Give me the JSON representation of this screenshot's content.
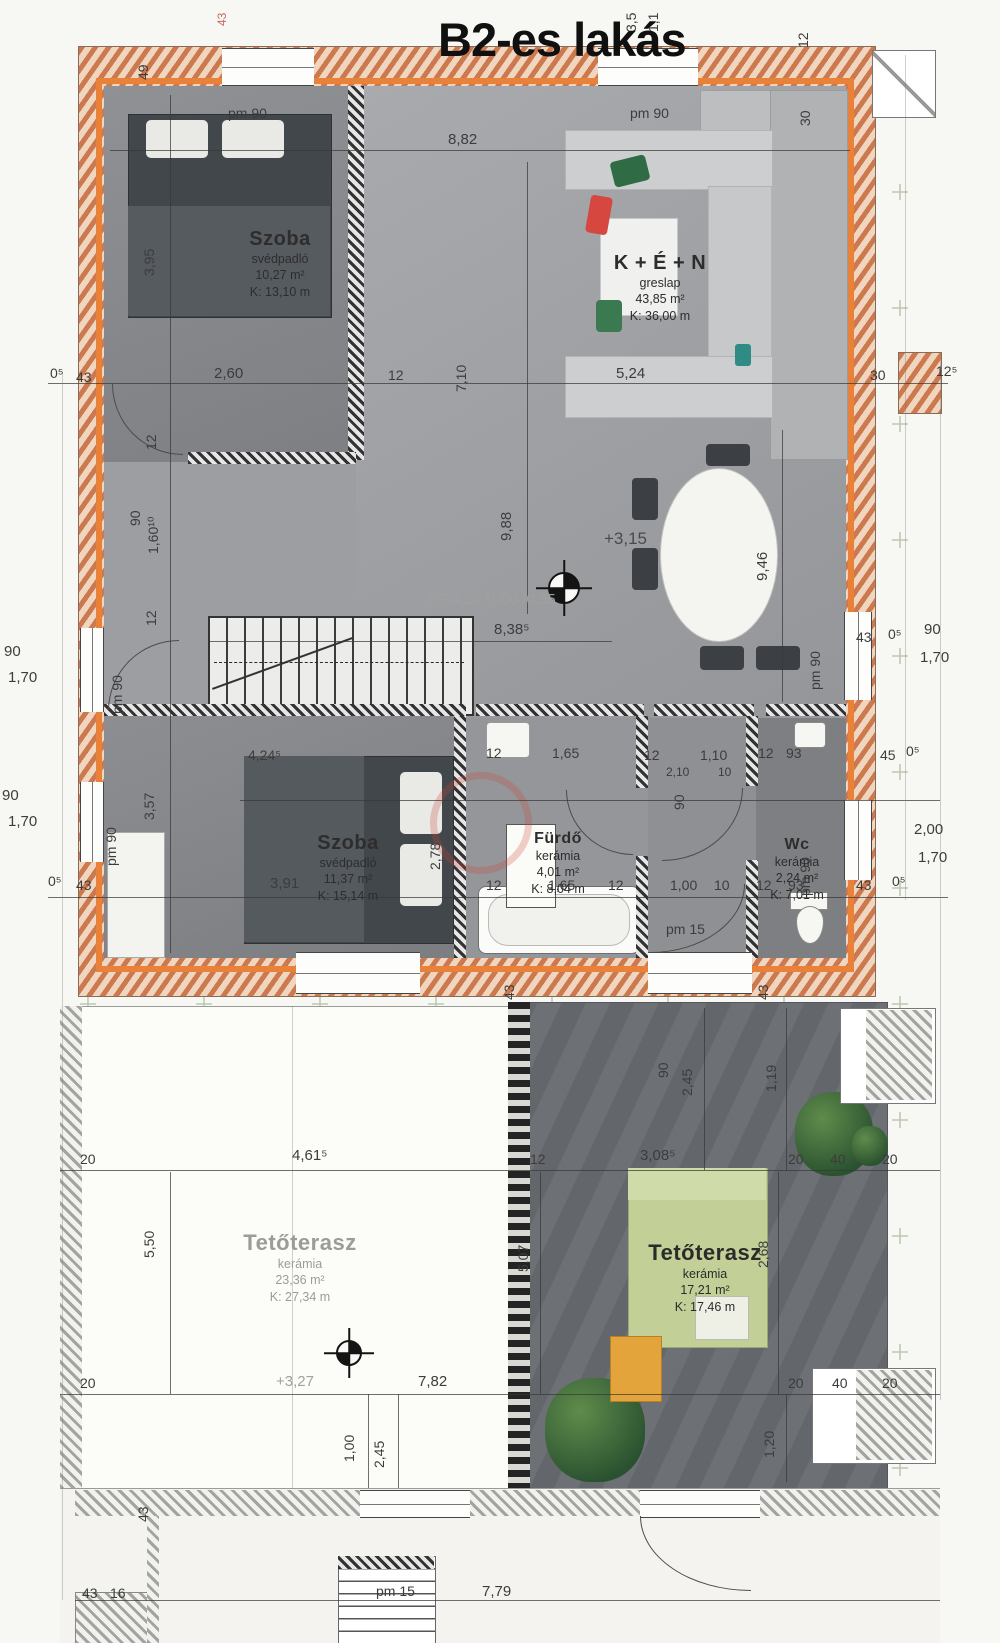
{
  "title": "B2-es lakás",
  "rooms": {
    "szoba1": {
      "name": "Szoba",
      "floor": "svédpadló",
      "area": "10,27 m²",
      "perimeter": "K:  13,10 m"
    },
    "ken": {
      "name": "K + É + N",
      "floor": "greslap",
      "area": "43,85 m²",
      "perimeter": "K:  36,00 m"
    },
    "szoba2": {
      "name": "Szoba",
      "floor": "svédpadló",
      "area": "11,37 m²",
      "perimeter": "K:  15,14 m"
    },
    "furdo": {
      "name": "Fürdő",
      "floor": "kerámia",
      "area": "4,01 m²",
      "perimeter": "K:  8,04 m"
    },
    "wc": {
      "name": "Wc",
      "floor": "kerámia",
      "area": "2,24 m²",
      "perimeter": "K:  7,01 m"
    },
    "terasz1": {
      "name": "Tetőterasz",
      "floor": "kerámia",
      "area": "23,36 m²",
      "perimeter": "K:  27,34 m"
    },
    "terasz2": {
      "name": "Tetőterasz",
      "floor": "kerámia",
      "area": "17,21 m²",
      "perimeter": "K:  17,46 m"
    }
  },
  "markers": {
    "pm90": "pm 90",
    "pm15": "pm 15",
    "level_main": "+3,15",
    "level_terrace": "+3,27",
    "pf": "PF 4,25 /1,00 /0,35"
  },
  "dims": {
    "top_width": "8,82",
    "top_left_v": "49",
    "top_v1": "3,5",
    "top_v2": "1,1",
    "top_red": "43",
    "right_v1": "12",
    "right_v2": "30",
    "row_mid": [
      "0⁵",
      "43",
      "2,60",
      "12",
      "7,10",
      "5,24",
      "30",
      "12⁵"
    ],
    "col_left": [
      "3,95",
      "12",
      "90",
      "1,60¹⁰",
      "12",
      "3,57"
    ],
    "center_h1": "9,88",
    "center_h2": "9,46",
    "stair_width": "8,38⁵",
    "left_win1": [
      "90",
      "1,70"
    ],
    "left_win2": [
      "90",
      "1,70"
    ],
    "right_win1": [
      "43",
      "0⁵",
      "90",
      "1,70"
    ],
    "right_win2": [
      "2,00",
      "1,70"
    ],
    "row_bath": [
      "4,24⁵",
      "12",
      "1,65",
      "12",
      "90",
      "1,10",
      "12",
      "93",
      "45",
      "0⁵"
    ],
    "bath_sub": [
      "2,10",
      "10"
    ],
    "szoba2_v": "2,78",
    "row_bottom": [
      "0⁵",
      "43",
      "3,91",
      "12",
      "1,65",
      "12",
      "1,00",
      "10",
      "12",
      "93",
      "43",
      "0⁵"
    ],
    "wall_ticks": [
      "43",
      "43",
      "43"
    ],
    "terr_row1": [
      "20",
      "4,61⁵",
      "12",
      "3,08⁵",
      "20",
      "40",
      "20"
    ],
    "terr_v1": [
      "90",
      "2,45",
      "1,19"
    ],
    "terr_v2": [
      "5,50",
      "5,07",
      "2,68"
    ],
    "terr_row2": [
      "20",
      "7,82",
      "20",
      "40",
      "20"
    ],
    "terr_v3": [
      "1,00",
      "2,45",
      "1,20"
    ],
    "strip_row": [
      "43",
      "16",
      "7,79"
    ]
  }
}
